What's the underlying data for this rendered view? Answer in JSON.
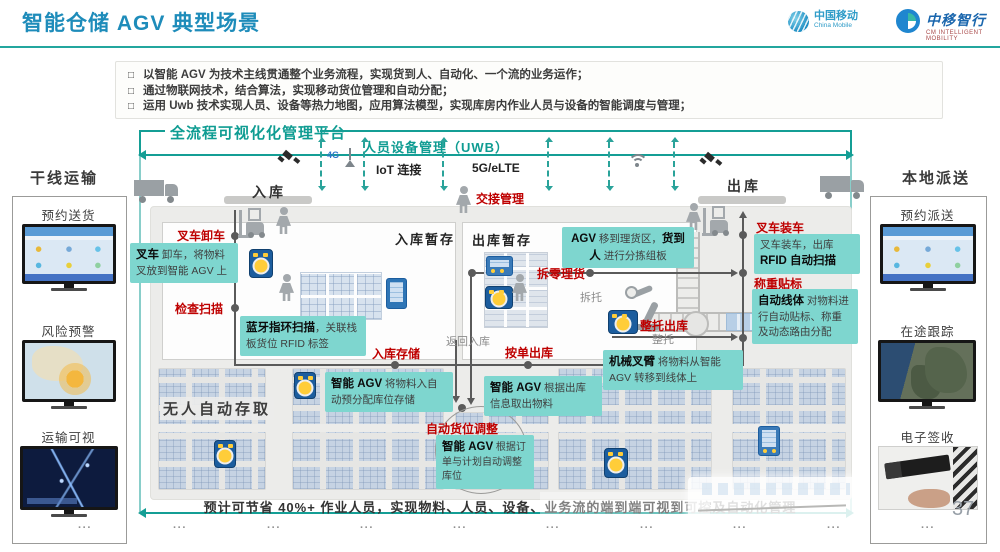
{
  "header": {
    "title": "智能仓储 AGV 典型场景",
    "logo_cmcc": {
      "name": "中国移动",
      "sub": "China Mobile"
    },
    "logo_cmim": {
      "name": "中移智行",
      "sub": "CM INTELLIGENT MOBILITY"
    }
  },
  "bullets": {
    "marker": "□",
    "items": [
      "以智能 AGV 为技术主线贯通整个业务流程，实现货到人、自动化、一个流的业务运作；",
      "通过物联网技术，结合算法，实现移动货位管理和自动分配；",
      "运用 Uwb 技术实现人员、设备等热力地图，应用算法模型，实现库房内作业人员与设备的智能调度与管理；"
    ]
  },
  "platform": {
    "title": "全流程可视化化管理平台",
    "uwb": "人员设备管理（UWB）",
    "iot": "IoT 连接",
    "net": "5G/eLTE",
    "g4": "4G"
  },
  "side_left": {
    "title": "干线运输",
    "items": [
      "预约送货",
      "风险预警",
      "运输可视"
    ]
  },
  "side_right": {
    "title": "本地派送",
    "items": [
      "预约派送",
      "在途跟踪",
      "电子签收"
    ]
  },
  "zones": {
    "inbound": "入库",
    "outbound": "出库",
    "inbound_staging": "入库暂存",
    "outbound_staging": "出库暂存",
    "auto_storage": "无人自动存取"
  },
  "steps": {
    "handover": "交接管理",
    "unload": "叉车卸车",
    "check_scan": "检查扫描",
    "store_in": "入库存储",
    "break_pick": "拆零理货",
    "pallet_out": "整托出库",
    "order_out": "按单出库",
    "slot_adjust": "自动货位调整",
    "load": "叉车装车",
    "weigh_label": "称重贴标"
  },
  "notes": {
    "depal": "拆托",
    "pallet": "整托",
    "return_in": "返回入库"
  },
  "callouts": {
    "c1": {
      "lead": "叉车",
      "rest": " 卸车，将物料叉放到智能 AGV 上"
    },
    "c2": {
      "lead": "蓝牙指环扫描",
      "rest": "，关联栈板货位 RFID 标签"
    },
    "c3": {
      "lead": "AGV",
      "mid": " 移到理货区，",
      "lead2": "货到人",
      "rest": " 进行分拣组板"
    },
    "c4": {
      "lead": "智能 AGV",
      "rest": " 将物料入自动预分配库位存储"
    },
    "c5": {
      "lead": "智能 AGV",
      "rest": " 根据出库信息取出物料"
    },
    "c6": {
      "lead": "机械叉臂",
      "rest": " 将物料从智能 AGV 转移到线体上"
    },
    "c7": {
      "lead": "智能 AGV",
      "rest": " 根据订单与计划自动调整库位"
    },
    "c8": {
      "pre": "叉车装车，出库 ",
      "lead": "RFID 自动扫描"
    },
    "c9": {
      "lead": "自动线体",
      "rest": " 对物料进行自动贴标、称重及动态路由分配"
    }
  },
  "footer": {
    "summary": "预计可节省 40%+ 作业人员，实现物料、人员、设备、业务流的端到端可视到可控及自动化管理",
    "page": "37",
    "dots": "···"
  }
}
